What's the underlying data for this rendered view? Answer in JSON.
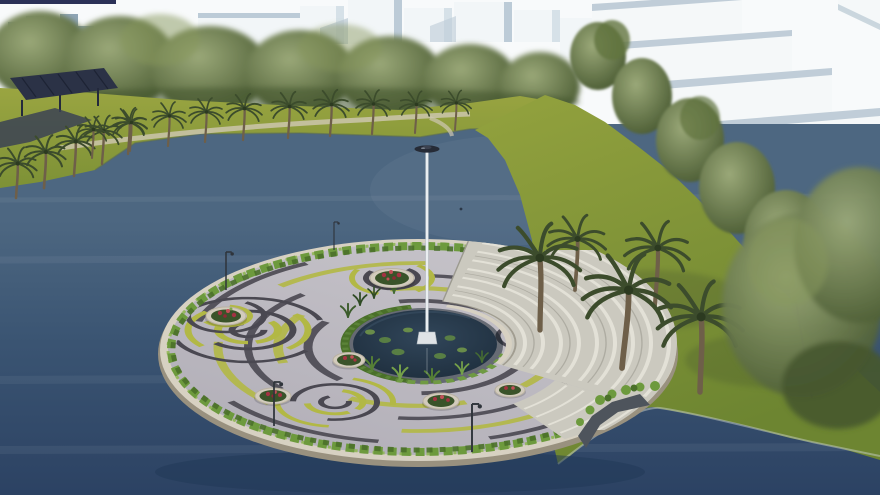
{
  "meta": {
    "title": "3D architectural rendering of a circular island plaza with central flagpole on a lake",
    "alt": "Aerial architectural visualization: a round island plaza with swirling grey, charcoal and grass-band paving, a central lily pond with a tall white flagpole, curved amphitheater steps, circular planters of red flowers and a hedge ring, set in a dark blue lake ringed by palm-lined grass banks, dense tree lines and white massing-model buildings."
  },
  "scene": {
    "sky": "overcast white sky",
    "background": {
      "city_blocks": "white massing-model city blocks with blue-grey shading",
      "building_row_right": "row of large white slab buildings receding to the lower right",
      "tree_line": "dense green tree line behind the far shore",
      "palm_promenade": "row of palm trees along the far grass bank",
      "pergola": "dark trellis structure on the upper-left bank"
    },
    "water": "dark slate-blue lake surrounding the island",
    "island": {
      "label": "circular plaza island",
      "paving_pattern": "concentric swirl paving in light grey, charcoal and yellow-green grass bands",
      "features": [
        "central reflecting pond with lily pads",
        "tall white flagpole with dark crown disc",
        "perimeter hedge ring on a stone rim",
        "curved amphitheater steps on the right",
        "side stair flight to the shore",
        "circular stone planters with red blooms",
        "park light poles"
      ],
      "planter_count": 6,
      "lamp_count": 4
    },
    "peninsula": "landscaped right shore with tall palms, leafy trees, hedge and a dark walkway",
    "top_edge_bar": "thin dark navy strip at the top-left image edge"
  },
  "colors": {
    "sky": "#f8fafb",
    "cityFace": "#f2f6f8",
    "citySide": "#d6e1e8",
    "cityShade": "#bccbd7",
    "cityDark": "#7f98ac",
    "slabFace": "#f5f8f9",
    "slabSide": "#e3eaee",
    "slabShadow": "#c9d5dd",
    "slabTop": "#aebfcc",
    "treeDark": "#46572f",
    "treeMid": "#61743f",
    "treeLight": "#87975c",
    "treeSoft": "#9aa878",
    "palmFrond": "#3c4c2c",
    "palmTrunk": "#6e5f49",
    "grassTop": "#9aa541",
    "grassDeep": "#7d9136",
    "grassPen": "#93a23e",
    "grassPenDeep": "#6d8531",
    "waterTop": "#4d6781",
    "waterMid": "#3a5472",
    "waterDeep": "#2c4263",
    "waterEdge": "#6c8193",
    "pergola": "#2b3246",
    "rimStone": "#d7d1c2",
    "rimWall": "#99917f",
    "hedge": "#6d9a3d",
    "hedgeDark": "#4a7029",
    "hedgeLite": "#8db64e",
    "pave": "#b1aeb7",
    "paveLight": "#c7c4ca",
    "paveDark": "#4a4851",
    "grassBand": "#b2b845",
    "pond": "#1b2a38",
    "pondEdge": "#31465a",
    "lily": "#5d8444",
    "steps": "#cbc9bf",
    "stepsLight": "#e3e1d7",
    "stepsShade": "#a8a69c",
    "planterStone": "#d2cbbc",
    "planterGreen": "#3a5329",
    "flowerRed": "#a43242",
    "flowerBright": "#c24f58",
    "poleWhite": "#eaeef1",
    "poleEdge": "#b4bdc4",
    "discDark": "#262b36",
    "lamp": "#2f343b",
    "path": "#4e545c",
    "topBar": "#2b3157",
    "shoreSand": "#cfc8b4"
  }
}
